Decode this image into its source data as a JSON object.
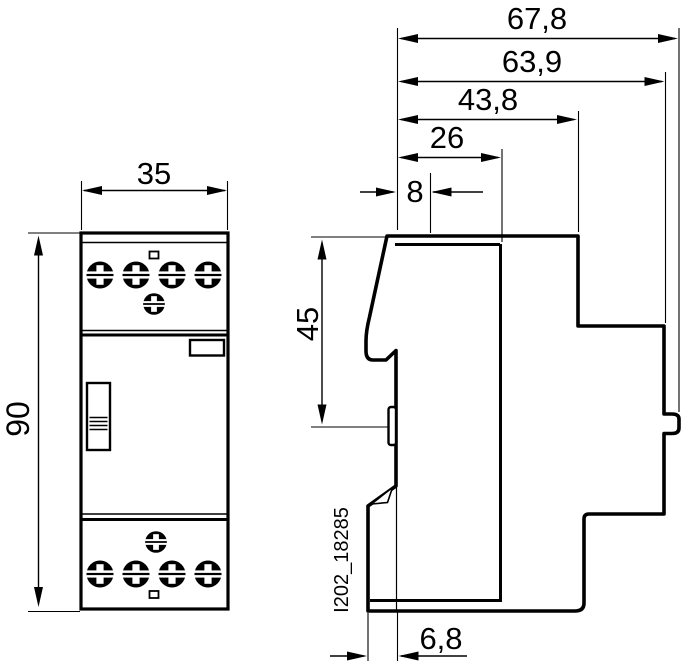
{
  "drawing": {
    "drawing_id": "I202_18285",
    "dims": {
      "overall_depth": "67,8",
      "body_depth": "63,9",
      "front_depth": "43,8",
      "upper_depth": "26",
      "front_offset": "8",
      "module_width": "35",
      "module_height": "90",
      "din_height": "45",
      "clip_depth": "6,8"
    },
    "colors": {
      "line": "#000000",
      "background": "#ffffff"
    }
  }
}
